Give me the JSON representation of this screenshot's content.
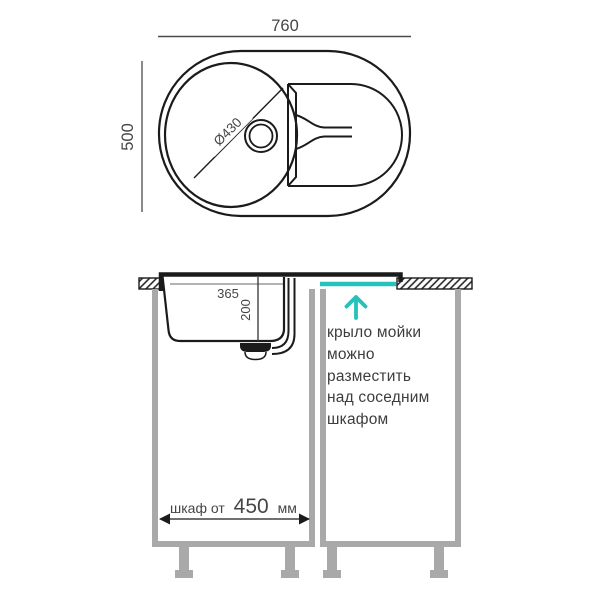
{
  "colors": {
    "accent": "#25c1bb",
    "ink": "#1b1b1b",
    "gray": "#a9a9a9",
    "dim": "#8a8a8a",
    "text": "#3d3d3d"
  },
  "top_view": {
    "overall_width_mm": "760",
    "overall_depth_mm": "500",
    "bowl_diameter": "Ø430"
  },
  "section_view": {
    "wing_offset_mm": "365",
    "bowl_depth_mm": "200",
    "note_lines": [
      "крыло мойки",
      "можно",
      "разместить",
      "над соседним",
      "шкафом"
    ],
    "cabinet_dim": {
      "prefix": "шкаф от",
      "value": "450",
      "unit": "мм"
    }
  }
}
